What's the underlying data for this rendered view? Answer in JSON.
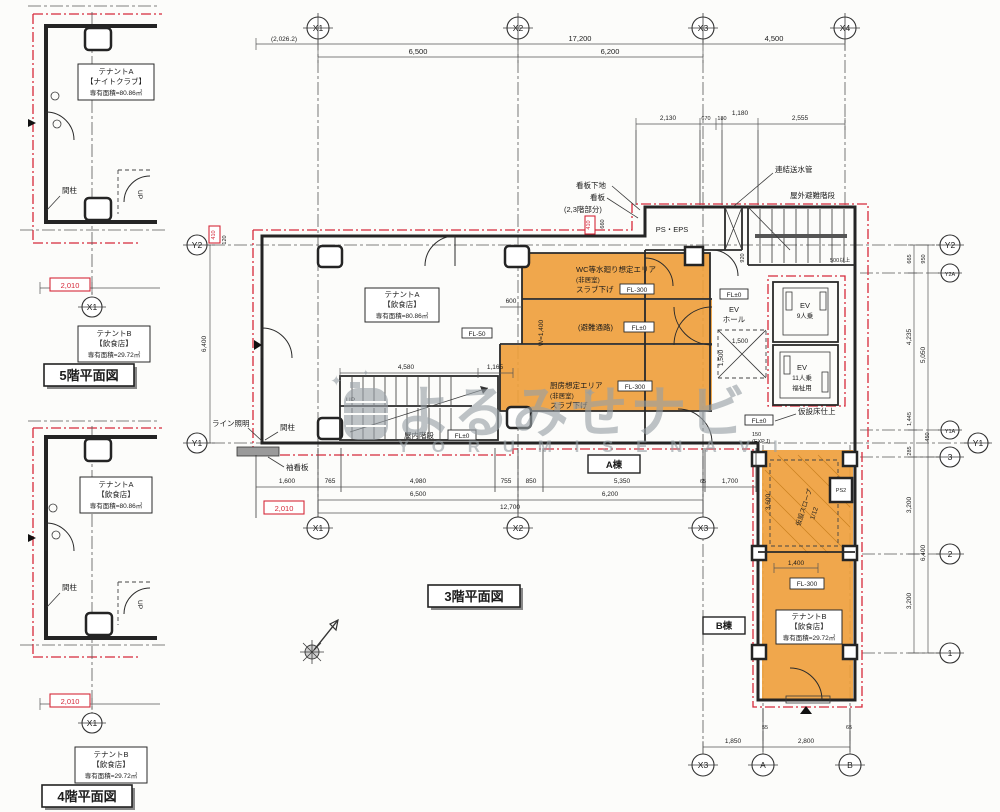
{
  "titles": {
    "f3": "3階平面図",
    "f4": "4階平面図",
    "f5": "5階平面図"
  },
  "wings": {
    "a": "A棟",
    "b": "B棟"
  },
  "tenants": {
    "f5a": [
      "テナントA",
      "【ナイトクラブ】",
      "専有面積=80.86㎡"
    ],
    "f5b": [
      "テナントB",
      "【飲食店】",
      "専有面積=29.72㎡"
    ],
    "f4a": [
      "テナントA",
      "【飲食店】",
      "専有面積=80.86㎡"
    ],
    "f4b": [
      "テナントB",
      "【飲食店】",
      "専有面積=29.72㎡"
    ],
    "f3a": [
      "テナントA",
      "【飲食店】",
      "専有面積=80.86㎡"
    ],
    "f3b": [
      "テナントB",
      "【飲食店】",
      "専有面積=29.72㎡"
    ]
  },
  "grid": {
    "x1": "X1",
    "x2": "X2",
    "x3": "X3",
    "x4": "X4",
    "y1": "Y1",
    "y2": "Y2",
    "y2a": "Y2A",
    "y1a": "Y1A",
    "g1": "1",
    "g2": "2",
    "g3": "3",
    "ga": "A",
    "gb": "B"
  },
  "dims": {
    "total_left": "(2,026.2)",
    "total_x": "17,200",
    "x1x2": "6,500",
    "x2x3": "6,200",
    "x3x4": "4,500",
    "sub1": "2,130",
    "sub2": "670",
    "sub3": "180",
    "sub4": "1,180",
    "sub5": "2,555",
    "left_410": "410",
    "left_120": "120",
    "left_6400": "6,400",
    "sign_410": "410",
    "sign_660": "660",
    "stair_920": "920",
    "min500": "500以上",
    "ev_1500h": "1,500",
    "ev_1500v": "1,500",
    "c600": "600",
    "w1400": "W=1,400",
    "stair_4580": "4,580",
    "stair_1165": "1,165",
    "b1": "1,600",
    "b2": "765",
    "b3": "4,980",
    "b4": "755",
    "b5": "850",
    "b6": "5,350",
    "b7": "65",
    "b8": "1,700",
    "b9": "6,500",
    "b10": "6,200",
    "b11": "12,700",
    "red2010": "2,010",
    "r665": "665",
    "r950": "950",
    "r4235": "4,235",
    "r5050": "5,050",
    "r1445": "1,445",
    "r450": "450",
    "r285": "285",
    "bw3200a": "3,200",
    "bw6400": "6,400",
    "bw3200b": "3,200",
    "bw3600": "3,600",
    "bw1400": "1,400",
    "exp150": "150",
    "expj": "(EXP.J)",
    "bw55": "55",
    "bw65": "65",
    "bw1850": "1,850",
    "bw2800": "2,800"
  },
  "labels": {
    "renketsu": "連結送水管",
    "sotokaidan": "屋外避難階段",
    "kanban_shitaji": "看板下地",
    "kanban": "看板",
    "kanban_note": "(2,3階部分)",
    "pseps": "PS・EPS",
    "ev": "EV",
    "ev_hall": "ホール",
    "ev9": "9人乗",
    "ev11": "11人乗",
    "fukushi": "福祉用",
    "fl0": "FL±0",
    "fl50": "FL-50",
    "fl300": "FL-300",
    "wc1": "WC等水廻り想定エリア",
    "wc2": "(非居室)",
    "wc3": "スラブ下げ",
    "hinan": "(避難通路)",
    "k1": "厨房想定エリア",
    "k2": "(非居室)",
    "k3": "スラブ下げ",
    "okunai": "屋内階段",
    "up": "UP",
    "mabashira": "間柱",
    "line_light": "ライン照明",
    "sode_kanban": "袖看板",
    "kasetsu_yuka": "仮設床仕上",
    "slope": "仮設スロープ",
    "slope_ratio": "1/12",
    "ps2": "PS2"
  },
  "watermark": {
    "jp": "よるみせナビ",
    "en": "Y O R U M I S E N A V I"
  }
}
